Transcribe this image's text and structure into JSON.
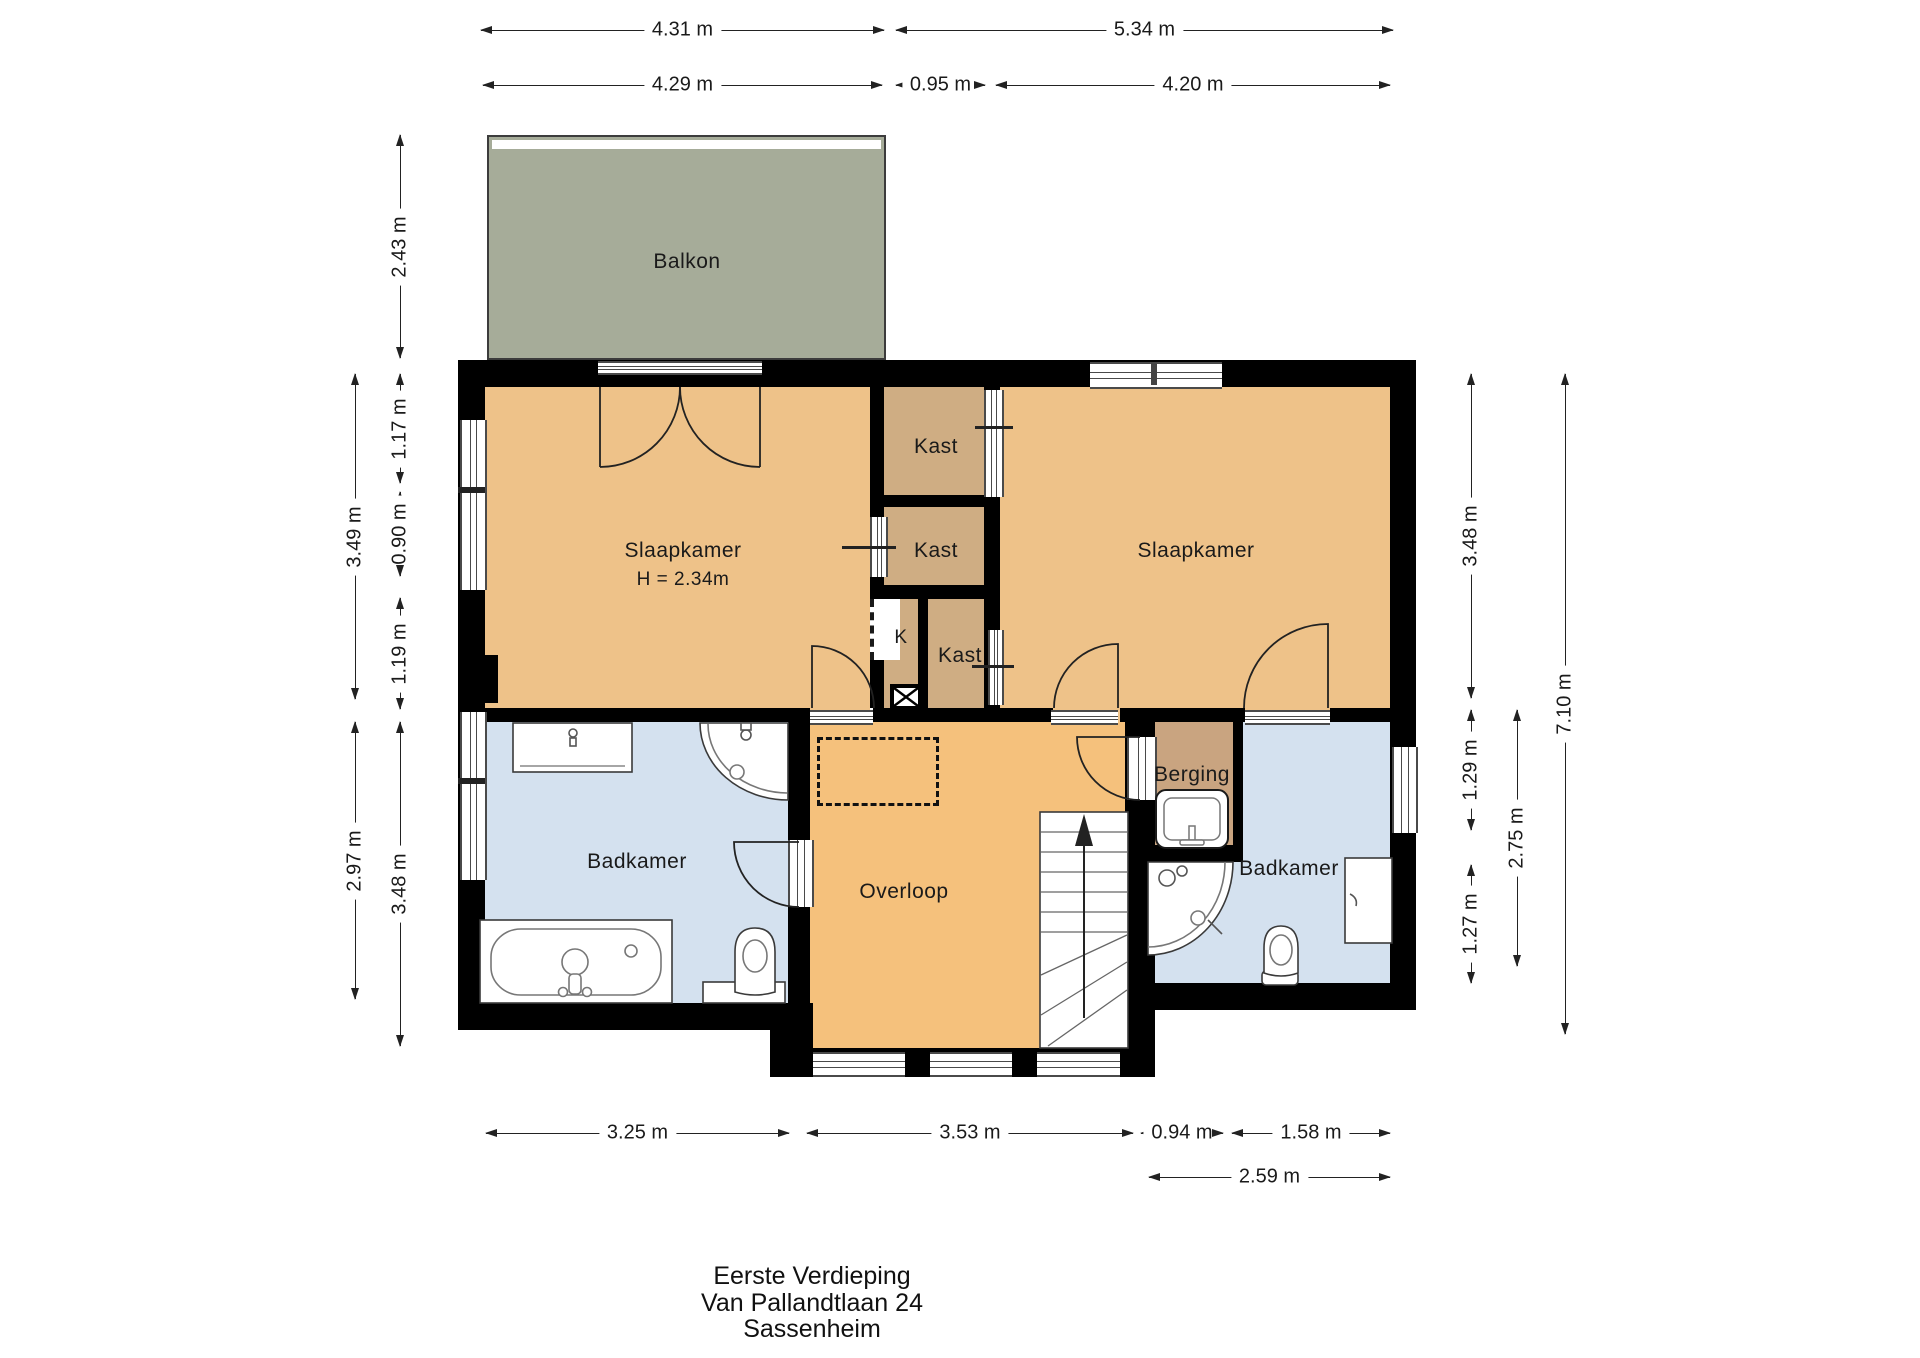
{
  "title_block": {
    "line1": "Eerste Verdieping",
    "line2": "Van Pallandtlaan 24",
    "line3": "Sassenheim"
  },
  "rooms": {
    "balkon": {
      "label": "Balkon"
    },
    "slaapkamer_links": {
      "label": "Slaapkamer",
      "height_note": "H = 2.34m"
    },
    "slaapkamer_rechts": {
      "label": "Slaapkamer"
    },
    "kast_boven": {
      "label": "Kast"
    },
    "kast_midden": {
      "label": "Kast"
    },
    "kast_onder": {
      "label": "Kast"
    },
    "k_schacht": {
      "label": "K"
    },
    "badkamer_links": {
      "label": "Badkamer"
    },
    "overloop": {
      "label": "Overloop"
    },
    "berging": {
      "label": "Berging"
    },
    "badkamer_rechts": {
      "label": "Badkamer"
    }
  },
  "dimensions": {
    "top": [
      {
        "label": "4.31 m"
      },
      {
        "label": "5.34 m"
      },
      {
        "label": "4.29 m"
      },
      {
        "label": "0.95 m"
      },
      {
        "label": "4.20 m"
      }
    ],
    "left": [
      {
        "label": "2.43 m"
      },
      {
        "label": "3.49 m"
      },
      {
        "label": "1.17 m"
      },
      {
        "label": "0.90 m"
      },
      {
        "label": "1.19 m"
      },
      {
        "label": "2.97 m"
      },
      {
        "label": "3.48 m"
      }
    ],
    "right": [
      {
        "label": "3.48 m"
      },
      {
        "label": "1.29 m"
      },
      {
        "label": "1.27 m"
      },
      {
        "label": "2.75 m"
      },
      {
        "label": "7.10 m"
      }
    ],
    "bottom": [
      {
        "label": "3.25 m"
      },
      {
        "label": "3.53 m"
      },
      {
        "label": "0.94 m"
      },
      {
        "label": "1.58 m"
      },
      {
        "label": "2.59 m"
      }
    ]
  },
  "colors": {
    "wall": "#000000",
    "bedroom_fill": "#eec289",
    "hall_fill": "#f5c17c",
    "closet_fill": "#cfad83",
    "storage_fill": "#c9a480",
    "bathroom_fill": "#d4e1ef",
    "balcony_fill": "#a6ac99",
    "dimension_line": "#222222"
  }
}
